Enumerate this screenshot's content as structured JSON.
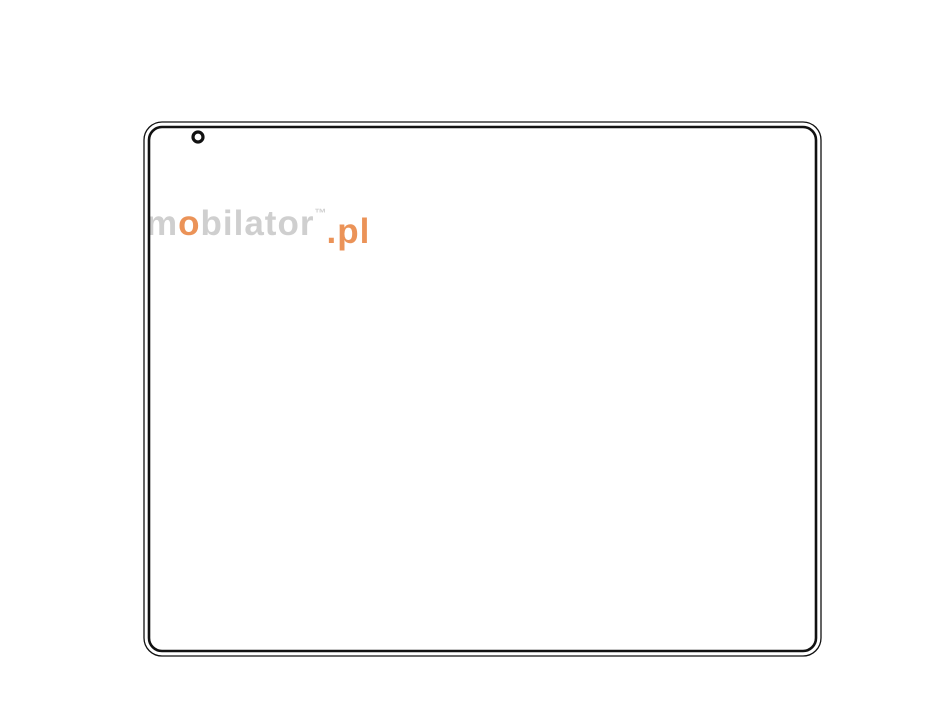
{
  "meta": {
    "bg": "#ffffff",
    "ink": "#111111",
    "dim_color": "#ee1009",
    "hole_color": "#c22a18",
    "opening_inner_color": "#8f8f8f",
    "watermark_gray": "#c7c7c7",
    "watermark_orange": "#e8813c"
  },
  "watermark": {
    "s1": "m",
    "s2": "o",
    "s3": "bilator",
    "tm": "™",
    "domain": ".pl"
  },
  "annotations": {
    "overall_width": "346.60",
    "vesa_width_100": "100",
    "vesa_width_75": "75",
    "overall_height": "270.60",
    "vesa_height_75": "75",
    "vesa_height_100": "100",
    "corner_radius": "R9",
    "mount_thread": "8-m4"
  },
  "geometry": {
    "canvas": [
      951,
      728
    ],
    "device": {
      "outer": [
        144,
        122,
        677,
        534,
        18
      ],
      "inner": [
        149,
        127,
        667,
        524,
        13
      ]
    },
    "cover_screws": {
      "row_xs": [
        198,
        386,
        578,
        767
      ],
      "row_ys": [
        137,
        641
      ],
      "col_ys_left": [
        179,
        390,
        600
      ],
      "col_ys_right": [
        180,
        392,
        601
      ],
      "col_x_left": 157,
      "col_x_right": 807,
      "r": 5,
      "sw": 3.2
    },
    "heatsink": {
      "top_y": 200,
      "bot_outer_y": 579.5,
      "bot_inner_y": 575,
      "left_outer_x": 173,
      "left_inner_x": 177.5,
      "right_outer_x": 792,
      "right_inner_x": 787.5,
      "top_x1": 205,
      "top_x2": 757,
      "side_y1": 235,
      "sep_top_y": 222,
      "sep_left_x": 207,
      "sep_right_x": 758,
      "panel_hlines_y": [
        271,
        531
      ],
      "corner_screws": [
        [
          194,
          264
        ],
        [
          770,
          264
        ],
        [
          194,
          553
        ],
        [
          770,
          553
        ]
      ],
      "comb_top": {
        "x1": 250,
        "x2": 718,
        "y1": 202,
        "y2": 219.5,
        "step": 3.57
      },
      "comb_left": {
        "y1": 274,
        "y2": 529,
        "x1": 179.5,
        "x2": 205,
        "step": 3.57
      },
      "comb_right": {
        "y1": 274,
        "y2": 529,
        "x1": 761,
        "x2": 786.5,
        "step": 3.57
      },
      "fans": {
        "offsets": [
          11,
          22,
          33
        ]
      },
      "bumps": [
        [
          210,
          186,
          14,
          14
        ],
        [
          740,
          186,
          14,
          14
        ]
      ],
      "top_tabs": [
        [
          528,
          33
        ],
        [
          605,
          34
        ],
        [
          686,
          34
        ]
      ],
      "top_tab_y": 193.5,
      "top_tab_h": 6.5,
      "bottom_tabs": [
        [
          240,
          32
        ],
        [
          340,
          17
        ],
        [
          360,
          28
        ],
        [
          392,
          12
        ],
        [
          600,
          36
        ],
        [
          664,
          38
        ]
      ],
      "bottom_tab_y": 579.5,
      "bottom_tab_h": 6.5
    },
    "fins": {
      "x0": 216,
      "step": 10.72,
      "count": 51,
      "y_top": 227,
      "y_bot": 553,
      "ring_zone": [
        344,
        610
      ],
      "short_top": [
        227,
        292
      ],
      "short_bot": [
        488,
        553
      ],
      "tl": {
        "limit": 352,
        "base": 240,
        "slope": 0.78
      },
      "bl": {
        "limit": 344,
        "base": 541,
        "slope": 0.66
      },
      "mirror": 966,
      "min_x": 215,
      "max_x": 752,
      "clamp_top": 229,
      "clamp_bot": 551
    },
    "rings": {
      "count": 5,
      "o0": 8,
      "ostep": 10.72,
      "box": [
        397,
        349,
        557,
        432
      ],
      "chamfer": 16
    },
    "opening": {
      "outer": [
        397,
        349,
        557,
        432,
        16
      ],
      "inner": [
        402,
        354,
        552,
        427,
        12
      ]
    },
    "holes": {
      "halo_r": 8.5,
      "vesa75": {
        "pts": [
          [
            410,
            318
          ],
          [
            553,
            318
          ],
          [
            410,
            462
          ],
          [
            553,
            462
          ]
        ],
        "r": 3.6
      },
      "vesa100": {
        "pts": [
          [
            387,
            294
          ],
          [
            577,
            294
          ],
          [
            387,
            487
          ],
          [
            577,
            487
          ]
        ],
        "r": 2.7
      }
    },
    "dims": [
      {
        "name": "dim-overall-width",
        "key": "overall_width",
        "type": "h",
        "line": 43,
        "a": 149,
        "b": 814,
        "gap": [
          433,
          530
        ],
        "ext": [
          [
            149,
            38,
            120
          ],
          [
            814,
            38,
            120
          ]
        ],
        "text": [
          481.5,
          43
        ]
      },
      {
        "name": "dim-vesa-width-100",
        "key": "vesa_width_100",
        "type": "h",
        "line": 72,
        "a": 387,
        "b": 577,
        "gap": [
          456,
          508
        ],
        "ext": [
          [
            387,
            66,
            286
          ],
          [
            577,
            66,
            286
          ]
        ],
        "text": [
          482,
          72
        ]
      },
      {
        "name": "dim-vesa-width-75",
        "key": "vesa_width_75",
        "type": "h",
        "line": 103,
        "a": 410,
        "b": 553,
        "gap": [
          464,
          498
        ],
        "ext": [
          [
            410,
            97,
            310
          ],
          [
            553,
            97,
            310
          ]
        ],
        "text": [
          481.5,
          103
        ]
      },
      {
        "name": "dim-overall-height",
        "key": "overall_height",
        "type": "v",
        "line": 88,
        "a": 131,
        "b": 648,
        "gap": [
          341,
          438
        ],
        "ext": [
          [
            130.5,
            82,
            152
          ],
          [
            648,
            82,
            164
          ]
        ],
        "text": [
          88,
          389.5
        ]
      },
      {
        "name": "dim-vesa-height-75",
        "key": "vesa_height_75",
        "type": "v",
        "line": 848,
        "a": 318,
        "b": 462,
        "gap": [
          372,
          408
        ],
        "ext": [
          [
            318,
            557,
            848
          ],
          [
            462,
            557,
            848
          ]
        ],
        "text": [
          848,
          390
        ]
      },
      {
        "name": "dim-vesa-height-100",
        "key": "vesa_height_100",
        "type": "v",
        "line": 881,
        "a": 294,
        "b": 487,
        "gap": [
          364,
          416
        ],
        "ext": [
          [
            294,
            581,
            881
          ],
          [
            487,
            581,
            881
          ]
        ],
        "text": [
          877,
          390.5
        ]
      }
    ],
    "leaders": [
      {
        "name": "leader-corner-radius",
        "key": "corner_radius",
        "line": [
          104,
          104,
          168,
          148
        ],
        "arrow": [
          146,
          132,
          45
        ],
        "text": [
          95,
          95
        ],
        "rot": 38
      },
      {
        "name": "leader-mount-thread",
        "key": "mount_thread",
        "line": [
          436,
          414,
          413,
          460
        ],
        "arrow": [
          412,
          459,
          133
        ],
        "text": [
          454,
          393
        ],
        "rot": -48
      }
    ],
    "dim_font": 27,
    "leader_font": 26
  }
}
